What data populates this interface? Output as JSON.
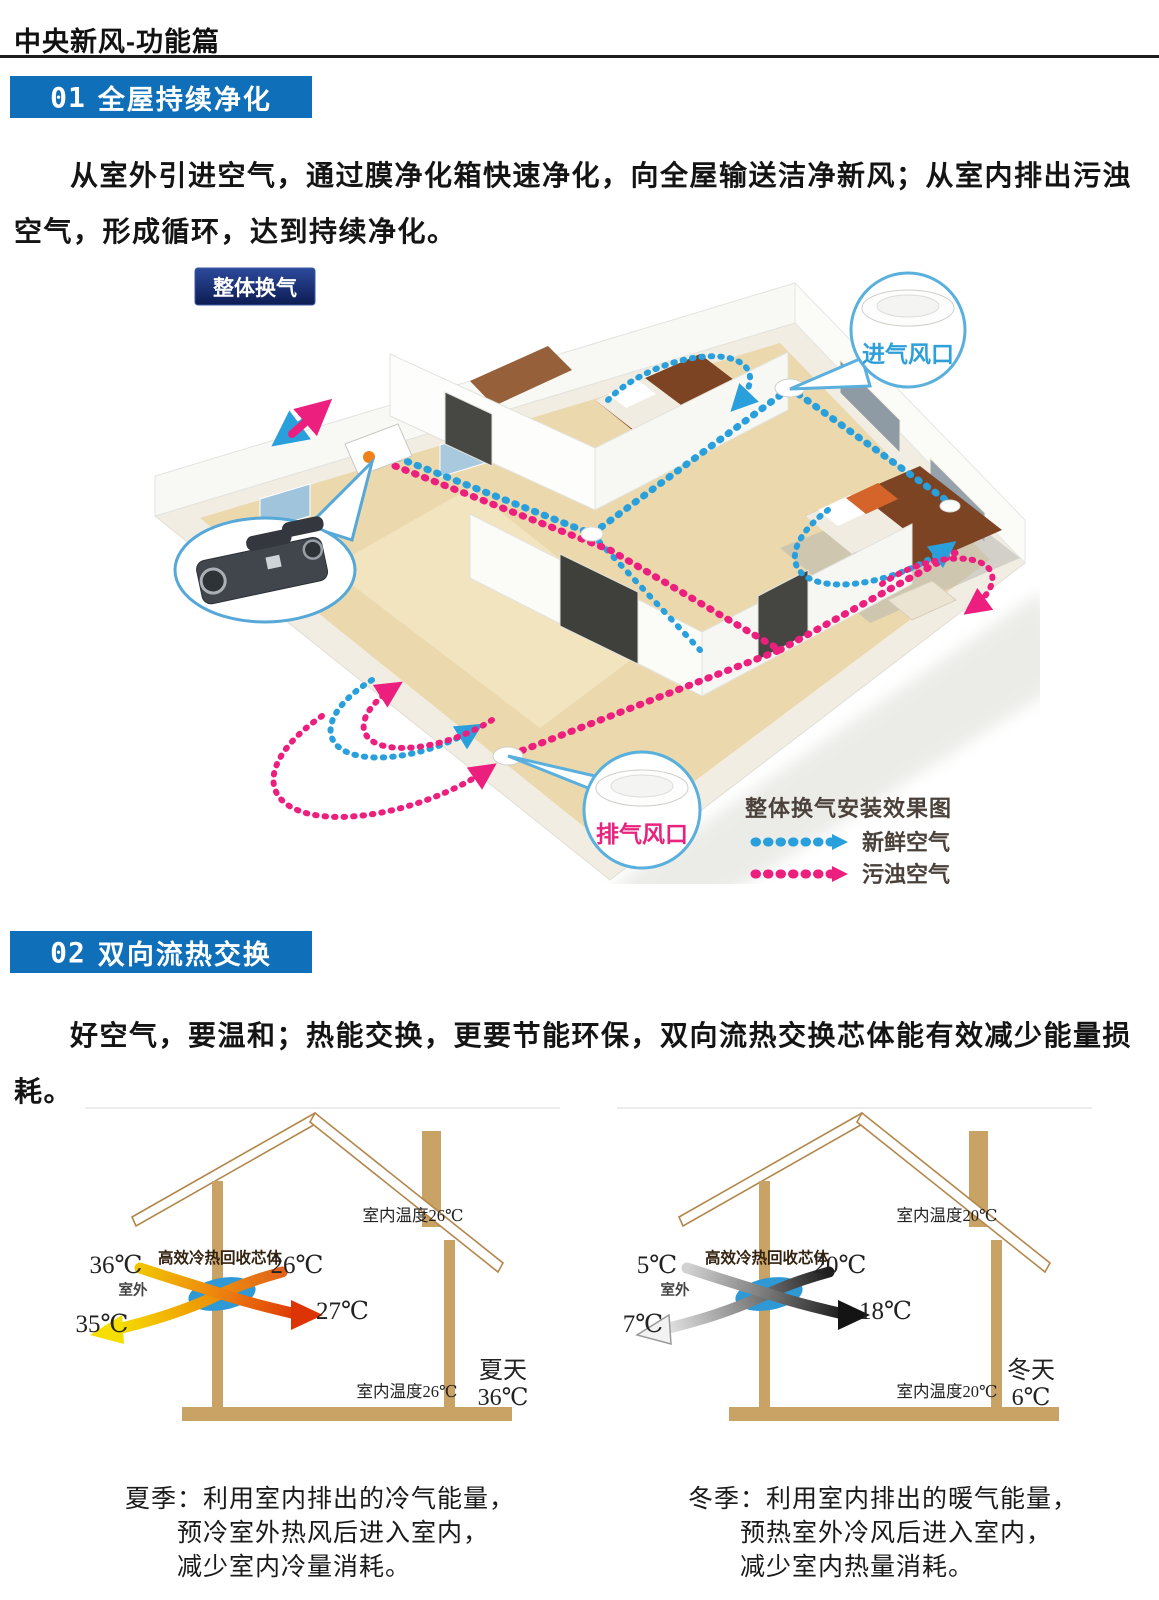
{
  "page": {
    "title": "中央新风-功能篇"
  },
  "section1": {
    "number": "01",
    "title": "全屋持续净化",
    "body": "从室外引进空气，通过膜净化箱快速净化，向全屋输送洁净新风；从室内排出污浊空气，形成循环，达到持续净化。",
    "diagram": {
      "badge": "整体换气",
      "intake_vent_label": "进气风口",
      "exhaust_vent_label": "排气风口",
      "legend_title": "整体换气安装效果图",
      "legend": [
        {
          "label": "新鲜空气",
          "color": "#29a0dc"
        },
        {
          "label": "污浊空气",
          "color": "#ec1f7e"
        }
      ]
    }
  },
  "section2": {
    "number": "02",
    "title": "双向流热交换",
    "body": "好空气，要温和；热能交换，更要节能环保，双向流热交换芯体能有效减少能量损耗。",
    "summer": {
      "core_label": "高效冷热回收芯体",
      "outdoor_label": "室外",
      "roof_temp": "室内温度26℃",
      "floor_temp": "室内温度26℃",
      "season": "夏天",
      "season_temp": "36℃",
      "outdoor_in_temp": "36℃",
      "exhaust_out_temp": "35℃",
      "indoor_return_temp": "26℃",
      "supply_in_temp": "27℃",
      "caption_line1": "夏季：利用室内排出的冷气能量，",
      "caption_line2": "预冷室外热风后进入室内，",
      "caption_line3": "减少室内冷量消耗。"
    },
    "winter": {
      "core_label": "高效冷热回收芯体",
      "outdoor_label": "室外",
      "roof_temp": "室内温度20℃",
      "floor_temp": "室内温度20℃",
      "season": "冬天",
      "season_temp": "6℃",
      "outdoor_in_temp": "5℃",
      "exhaust_out_temp": "7℃",
      "indoor_return_temp": "20℃",
      "supply_in_temp": "18℃",
      "caption_line1": "冬季：利用室内排出的暖气能量，",
      "caption_line2": "预热室外冷风后进入室内，",
      "caption_line3": "减少室内热量消耗。"
    }
  },
  "colors": {
    "banner_blue": "#0f6fb8",
    "badge_navy": "#152d72",
    "fresh_air_blue": "#29a0dc",
    "stale_air_pink": "#ec1f7e",
    "wood_tan": "#c9a265"
  }
}
